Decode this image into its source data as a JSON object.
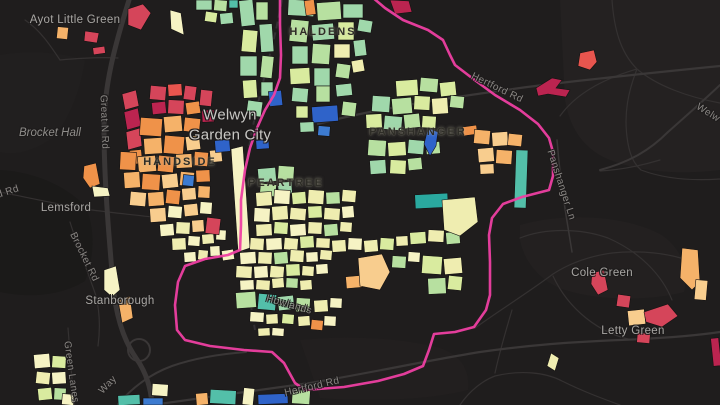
{
  "map": {
    "places": {
      "ayot_little_green": "Ayot Little Green",
      "brocket_hall": "Brocket Hall",
      "lemsford": "Lemsford",
      "stanborough": "Stanborough",
      "welwyn_garden_city_line1": "Welwyn",
      "welwyn_garden_city_line2": "Garden City",
      "cole_green": "Cole Green",
      "letty_green": "Letty Green"
    },
    "neighbourhoods": {
      "haldens": "HALDENS",
      "handside": "HANDSIDE",
      "peartree": "PEARTREE",
      "panshanger": "PANSHANGER"
    },
    "roads": {
      "great_n_rd": "Great N Rd",
      "d_rd": "d Rd",
      "brocket_rd": "Brocket Rd",
      "green_lanes": "Green Lanes",
      "way": "Way",
      "hertford_rd_bottom": "Hertford Rd",
      "hertford_rd_top": "Hertford Rd",
      "panshanger_ln": "Panshanger Ln",
      "howlands": "Howlands",
      "welw_partial": "Welw"
    },
    "colors": {
      "background": "#1f1d1d",
      "boundary_pink": "#ee3fa2",
      "road_gray": "#3a3737",
      "parcel_red": "#d5455a",
      "parcel_crimson": "#bb2450",
      "parcel_vermilion": "#e8554e",
      "parcel_orange": "#ef9249",
      "parcel_light_orange": "#f5b269",
      "parcel_sand": "#f8cd8e",
      "parcel_cream": "#f6f3c4",
      "parcel_pale_yellow": "#efedb0",
      "parcel_lime": "#d9eb9f",
      "parcel_green": "#b7e0a0",
      "parcel_mint": "#a0d8ab",
      "parcel_teal": "#53bfa9",
      "parcel_dark_teal": "#2aa99f",
      "parcel_blue": "#2f63c9",
      "parcel_mid_blue": "#3d7bd0"
    }
  }
}
